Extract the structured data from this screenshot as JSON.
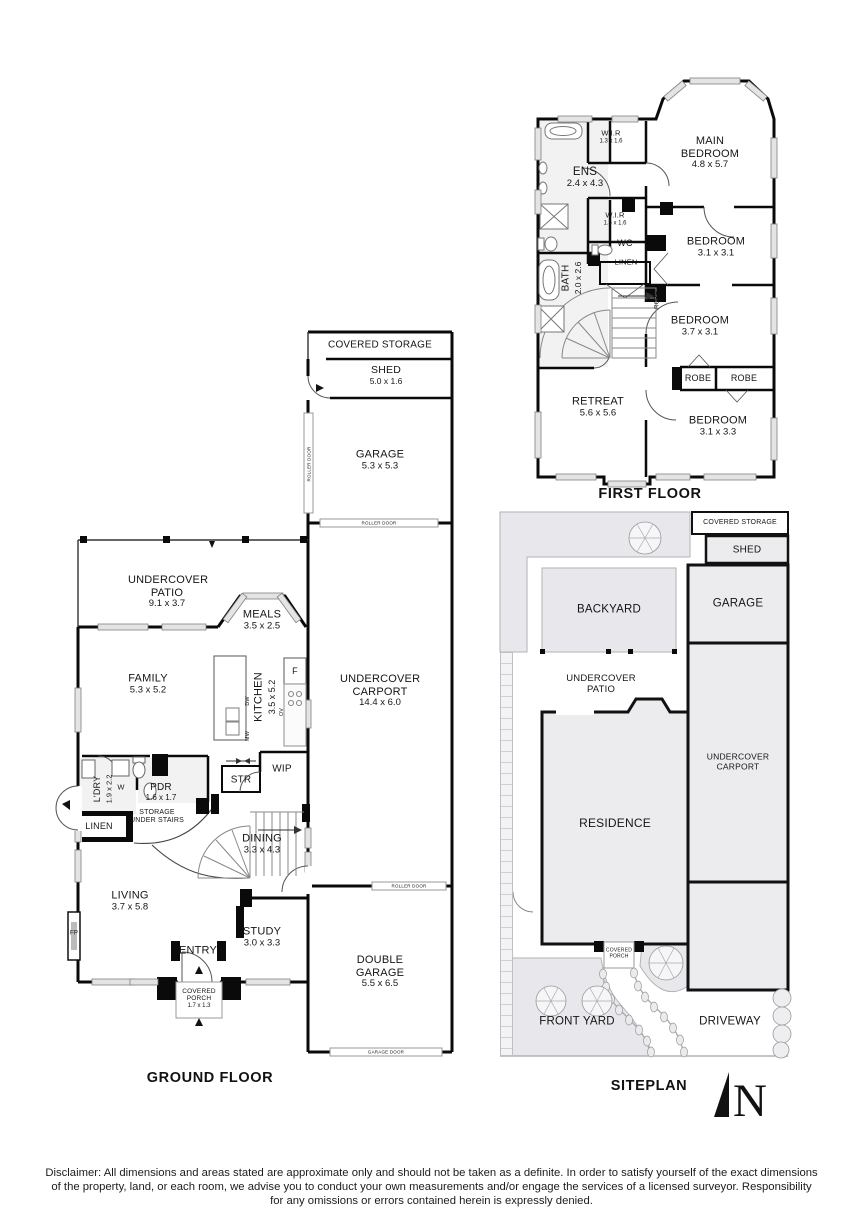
{
  "titles": {
    "ground_floor": "GROUND FLOOR",
    "first_floor": "FIRST FLOOR",
    "siteplan": "SITEPLAN"
  },
  "ff": {
    "wir1": {
      "name": "W.I.R",
      "dims": "1.3 x 1.6"
    },
    "main_bedroom": {
      "name": "MAIN BEDROOM",
      "dims": "4.8 x 5.7"
    },
    "ens": {
      "name": "ENS",
      "dims": "2.4 x 4.3"
    },
    "wir2": {
      "name": "W.I.R",
      "dims": "1.5 x 1.6"
    },
    "wc": {
      "name": "WC"
    },
    "linen": {
      "name": "LINEN"
    },
    "bath": {
      "name": "BATH",
      "dims": "2.0 x 2.6"
    },
    "bedroom2": {
      "name": "BEDROOM",
      "dims": "3.1 x 3.1"
    },
    "robe_nook": {
      "name": "ROBE"
    },
    "bedroom3": {
      "name": "BEDROOM",
      "dims": "3.7 x 3.1"
    },
    "robe1": {
      "name": "ROBE"
    },
    "robe2": {
      "name": "ROBE"
    },
    "retreat": {
      "name": "RETREAT",
      "dims": "5.6 x 5.6"
    },
    "bedroom4": {
      "name": "BEDROOM",
      "dims": "3.1 x 3.3"
    }
  },
  "gf": {
    "covered_storage": {
      "name": "COVERED STORAGE"
    },
    "shed": {
      "name": "SHED",
      "dims": "5.0 x 1.6"
    },
    "garage": {
      "name": "GARAGE",
      "dims": "5.3 x 5.3"
    },
    "roller_door_side": {
      "name": "ROLLER DOOR"
    },
    "roller_door_top": {
      "name": "ROLLER DOOR"
    },
    "roller_door_mid": {
      "name": "ROLLER DOOR"
    },
    "garage_door": {
      "name": "GARAGE DOOR"
    },
    "patio": {
      "name": "UNDERCOVER PATIO",
      "dims": "9.1 x 3.7"
    },
    "meals": {
      "name": "MEALS",
      "dims": "3.5 x 2.5"
    },
    "family": {
      "name": "FAMILY",
      "dims": "5.3 x 5.2"
    },
    "kitchen": {
      "name": "KITCHEN",
      "dims": "3.5 x 5.2"
    },
    "fridge": {
      "name": "F"
    },
    "dw": {
      "name": "DW"
    },
    "mw": {
      "name": "MW"
    },
    "ov": {
      "name": "OV"
    },
    "carport": {
      "name": "UNDERCOVER CARPORT",
      "dims": "14.4 x 6.0"
    },
    "wip": {
      "name": "WIP"
    },
    "str": {
      "name": "STR"
    },
    "ldry": {
      "name": "L'DRY",
      "dims": "1.9 x 2.2"
    },
    "washer": {
      "name": "W"
    },
    "pdr": {
      "name": "PDR",
      "dims": "1.6 x 1.7"
    },
    "storage_under_stairs": {
      "name": "STORAGE UNDER STAIRS"
    },
    "linen": {
      "name": "LINEN"
    },
    "dining": {
      "name": "DINING",
      "dims": "3.3 x 4.3"
    },
    "living": {
      "name": "LIVING",
      "dims": "3.7 x 5.8"
    },
    "fireplace": {
      "name": "FP"
    },
    "study": {
      "name": "STUDY",
      "dims": "3.0 x 3.3"
    },
    "entry": {
      "name": "ENTRY"
    },
    "covered_porch": {
      "name": "COVERED PORCH",
      "dims": "1.7 x 1.3"
    },
    "double_garage": {
      "name": "DOUBLE GARAGE",
      "dims": "5.5 x 6.5"
    }
  },
  "sp": {
    "covered_storage": "COVERED STORAGE",
    "shed": "SHED",
    "garage": "GARAGE",
    "backyard": "BACKYARD",
    "patio": "UNDERCOVER PATIO",
    "carport": "UNDERCOVER CARPORT",
    "residence": "RESIDENCE",
    "covered_porch": "COVERED PORCH",
    "front_yard": "FRONT YARD",
    "driveway": "DRIVEWAY",
    "north": "N"
  },
  "disclaimer": {
    "lines": [
      "Disclaimer: All dimensions and areas stated are approximate only and should not be taken as a definite. In order to satisfy yourself of the exact dimensions",
      "of the property, land, or each room, we advise you to conduct your own measurements and/or engage the services of a licensed surveyor. Responsibility",
      "for any omissions or errors contained herein is expressly denied."
    ]
  },
  "colors": {
    "wall": "#0a0a0a",
    "window_fill": "#e4e4e7",
    "yard_fill": "#e8e8ec",
    "building_fill": "#ececee",
    "tile_fill": "#f2f2f2"
  }
}
